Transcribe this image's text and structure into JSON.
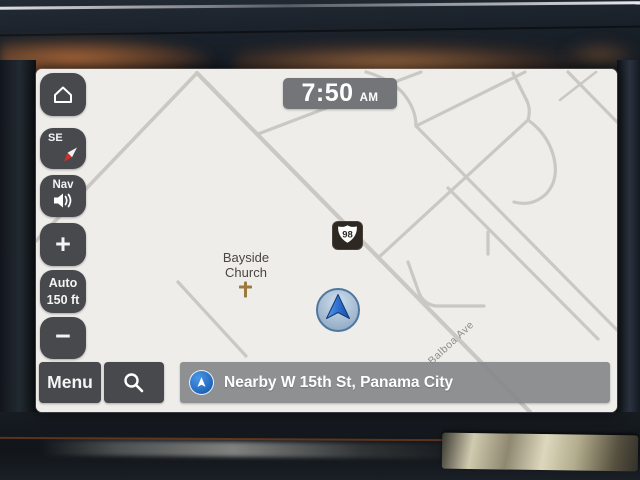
{
  "clock": {
    "time": "7:50",
    "meridiem": "AM"
  },
  "sidebar": {
    "compass_heading": "SE",
    "nav_volume_label": "Nav",
    "zoom_in_label": "+",
    "zoom_auto_label": "Auto",
    "zoom_scale_label": "150 ft",
    "zoom_out_label": "−"
  },
  "bottom_bar": {
    "menu_label": "Menu",
    "status_text": "Nearby W 15th St, Panama City"
  },
  "map": {
    "poi_church_line1": "Bayside",
    "poi_church_line2": "Church",
    "route_shield": "98",
    "street_label": "Balboa Ave"
  },
  "colors": {
    "button_bg": "#48494c",
    "status_bar_bg": "#87898b",
    "accent_blue": "#2478d0",
    "map_bg": "#eeede9",
    "road": "#c9c8c3",
    "shield_bg": "#2e2823",
    "church_icon": "#9b7a3e",
    "clock_bg": "#747578"
  }
}
